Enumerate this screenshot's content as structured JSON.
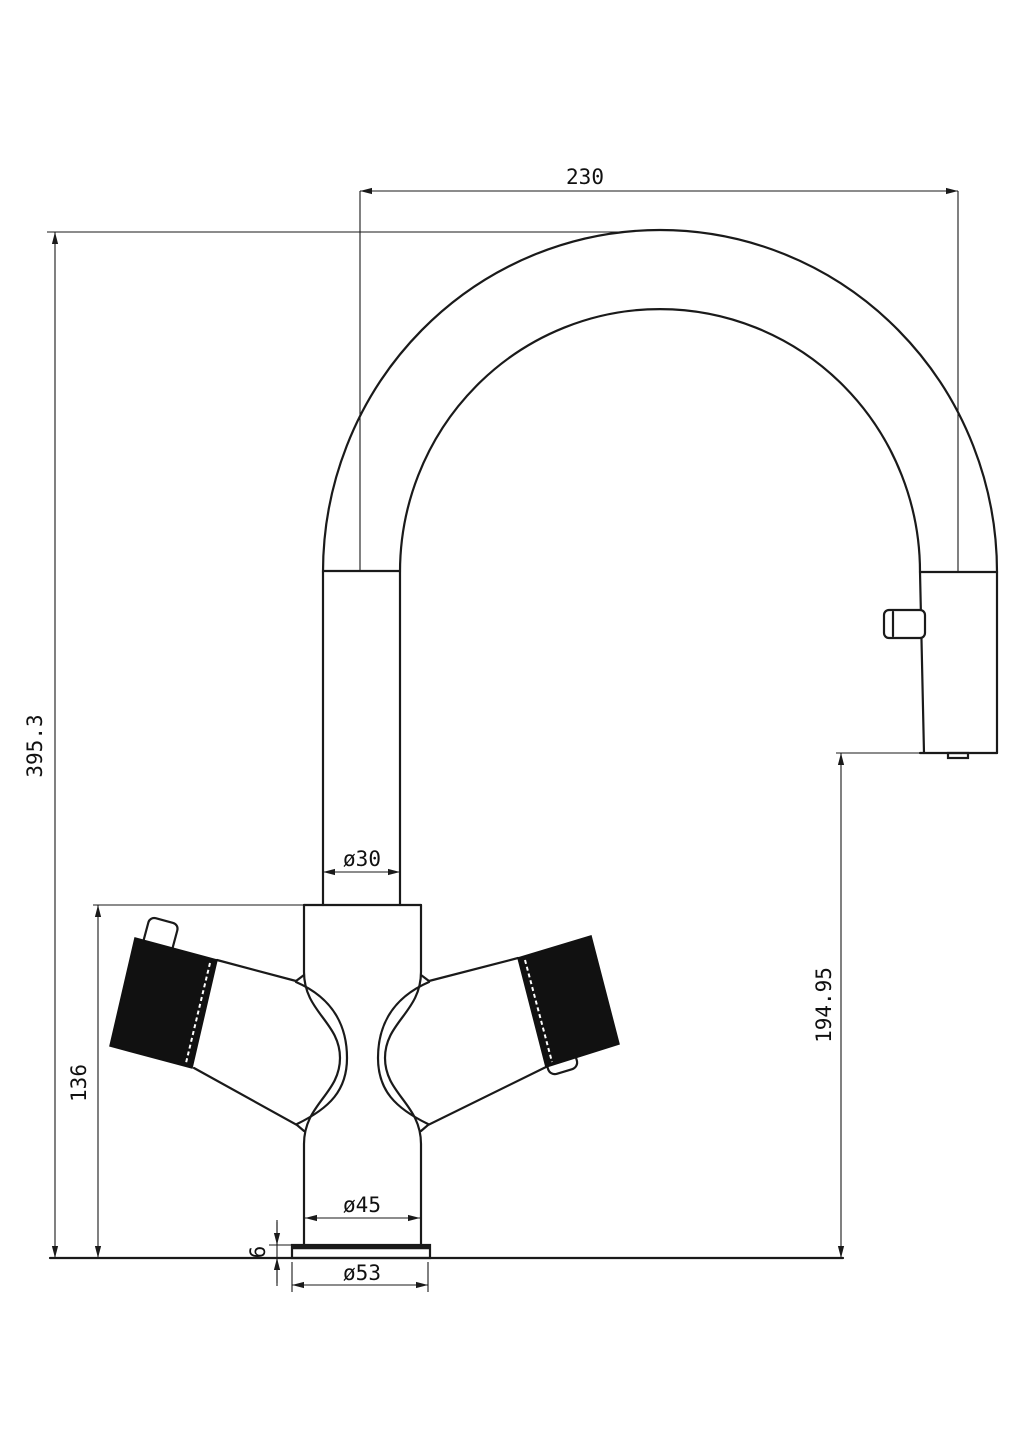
{
  "colors": {
    "background": "#ffffff",
    "line": "#1a1a1a",
    "handle_fill": "#111111"
  },
  "dimensions": {
    "spout_reach": "230",
    "overall_height": "395.3",
    "spout_tube_diameter": "ø30",
    "body_height": "136",
    "outlet_to_base": "194.95",
    "body_diameter": "ø45",
    "base_plate_thickness": "6",
    "base_plate_diameter": "ø53"
  }
}
